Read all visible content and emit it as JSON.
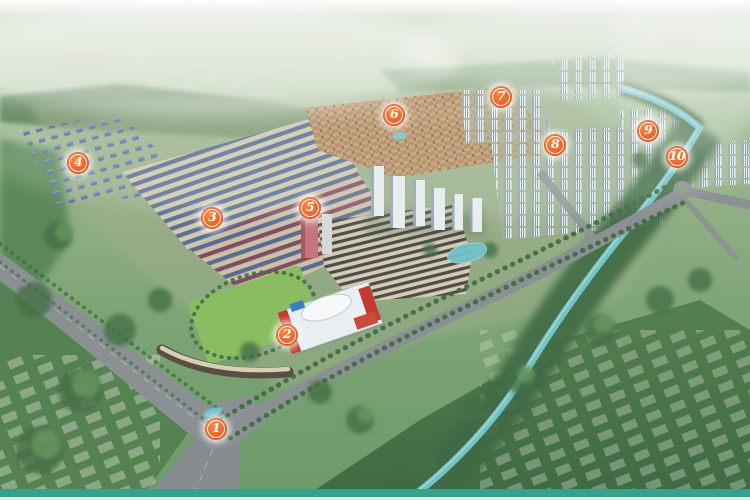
{
  "map": {
    "markers": [
      {
        "label": "1",
        "x": 216,
        "y": 429
      },
      {
        "label": "2",
        "x": 287,
        "y": 335
      },
      {
        "label": "3",
        "x": 212,
        "y": 218
      },
      {
        "label": "4",
        "x": 78,
        "y": 163
      },
      {
        "label": "5",
        "x": 310,
        "y": 208
      },
      {
        "label": "6",
        "x": 394,
        "y": 115
      },
      {
        "label": "7",
        "x": 501,
        "y": 97
      },
      {
        "label": "8",
        "x": 555,
        "y": 145
      },
      {
        "label": "9",
        "x": 648,
        "y": 131
      },
      {
        "label": "10",
        "x": 677,
        "y": 157
      }
    ],
    "colors": {
      "marker_fill": "#e8632a",
      "marker_ring": "#ffffff",
      "marker_glow": "#ffffff",
      "marker_text": "#ffffff",
      "footer_bar": "#36a28c",
      "footer_strip": "#e3f0ed",
      "river": "#74c3c7",
      "road": "#8b9093",
      "tree_canopy": "#4b7a4e"
    }
  }
}
